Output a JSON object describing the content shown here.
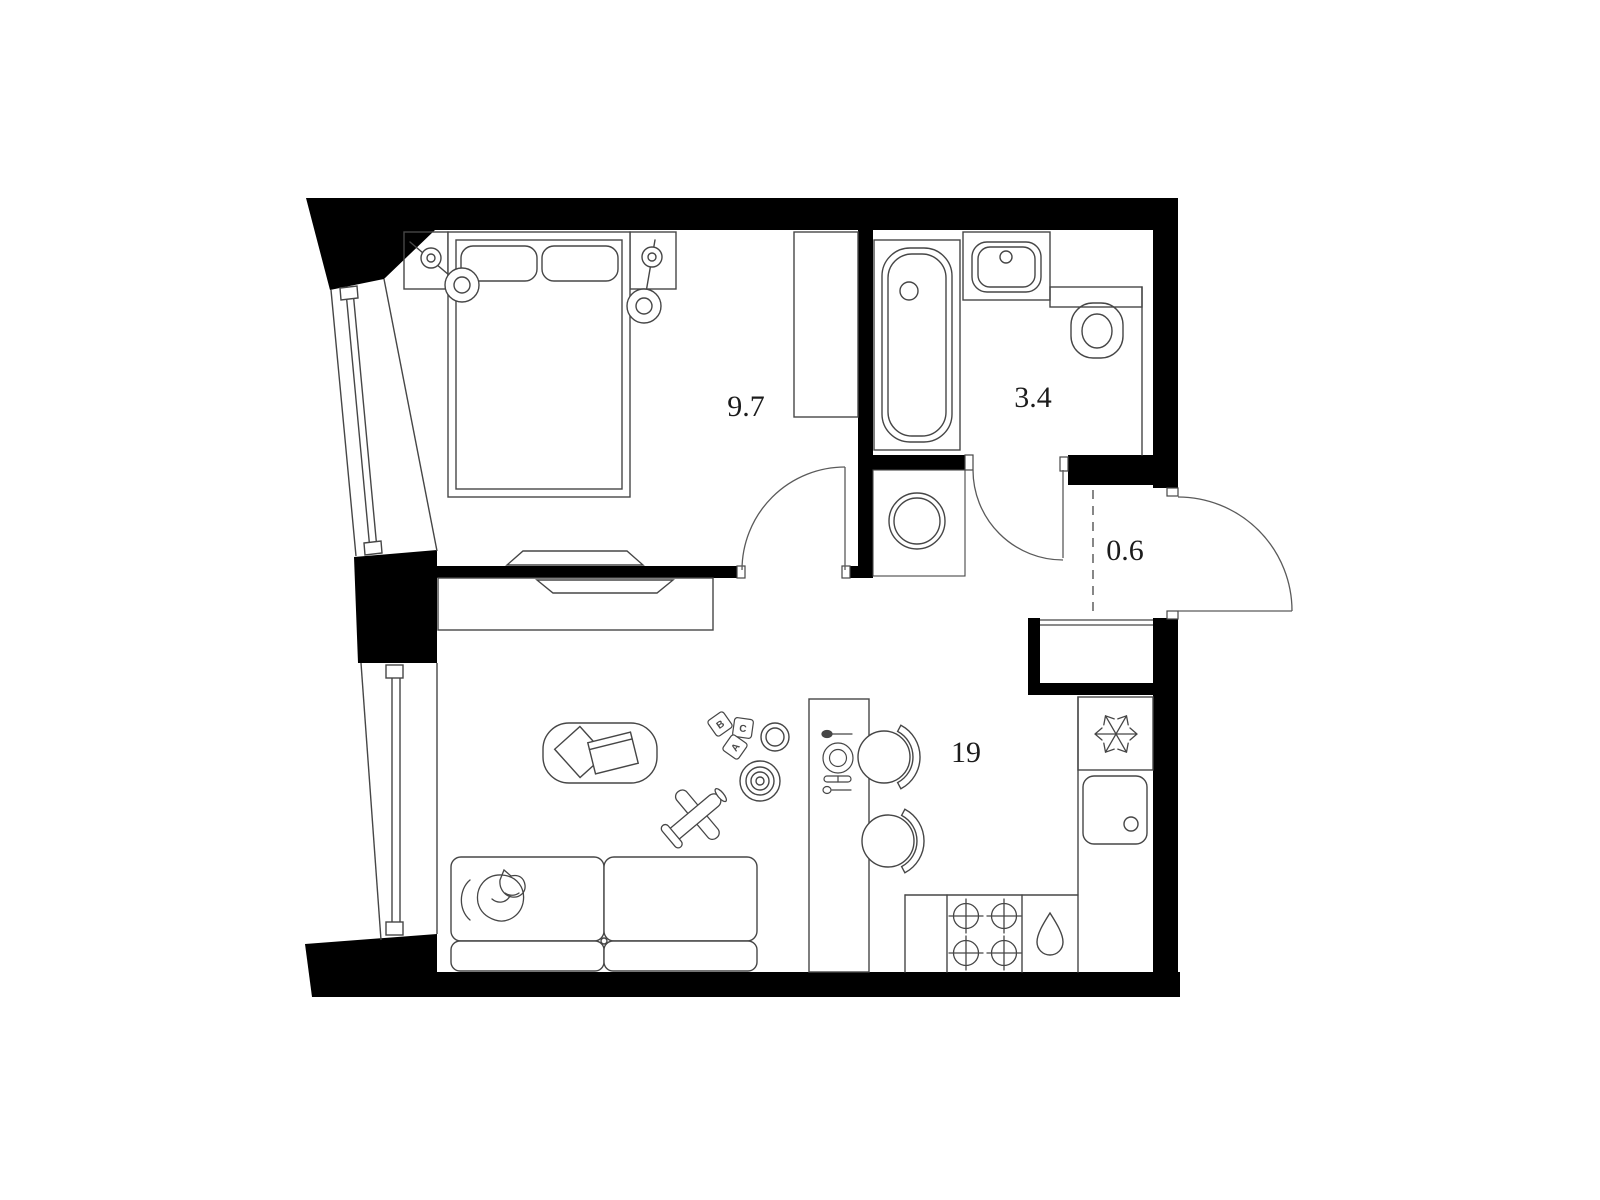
{
  "plan": {
    "name": "apartment-floor-plan",
    "colors": {
      "wall": "#000000",
      "line": "#464646",
      "background": "#ffffff",
      "label": "#1c1c1c"
    },
    "rooms": [
      {
        "id": "bedroom",
        "area_label": "9.7"
      },
      {
        "id": "bathroom",
        "area_label": "3.4"
      },
      {
        "id": "entry",
        "area_label": "0.6"
      },
      {
        "id": "living-kitchen",
        "area_label": "19"
      }
    ],
    "toy_blocks": {
      "letters": [
        "B",
        "C",
        "A"
      ]
    }
  }
}
